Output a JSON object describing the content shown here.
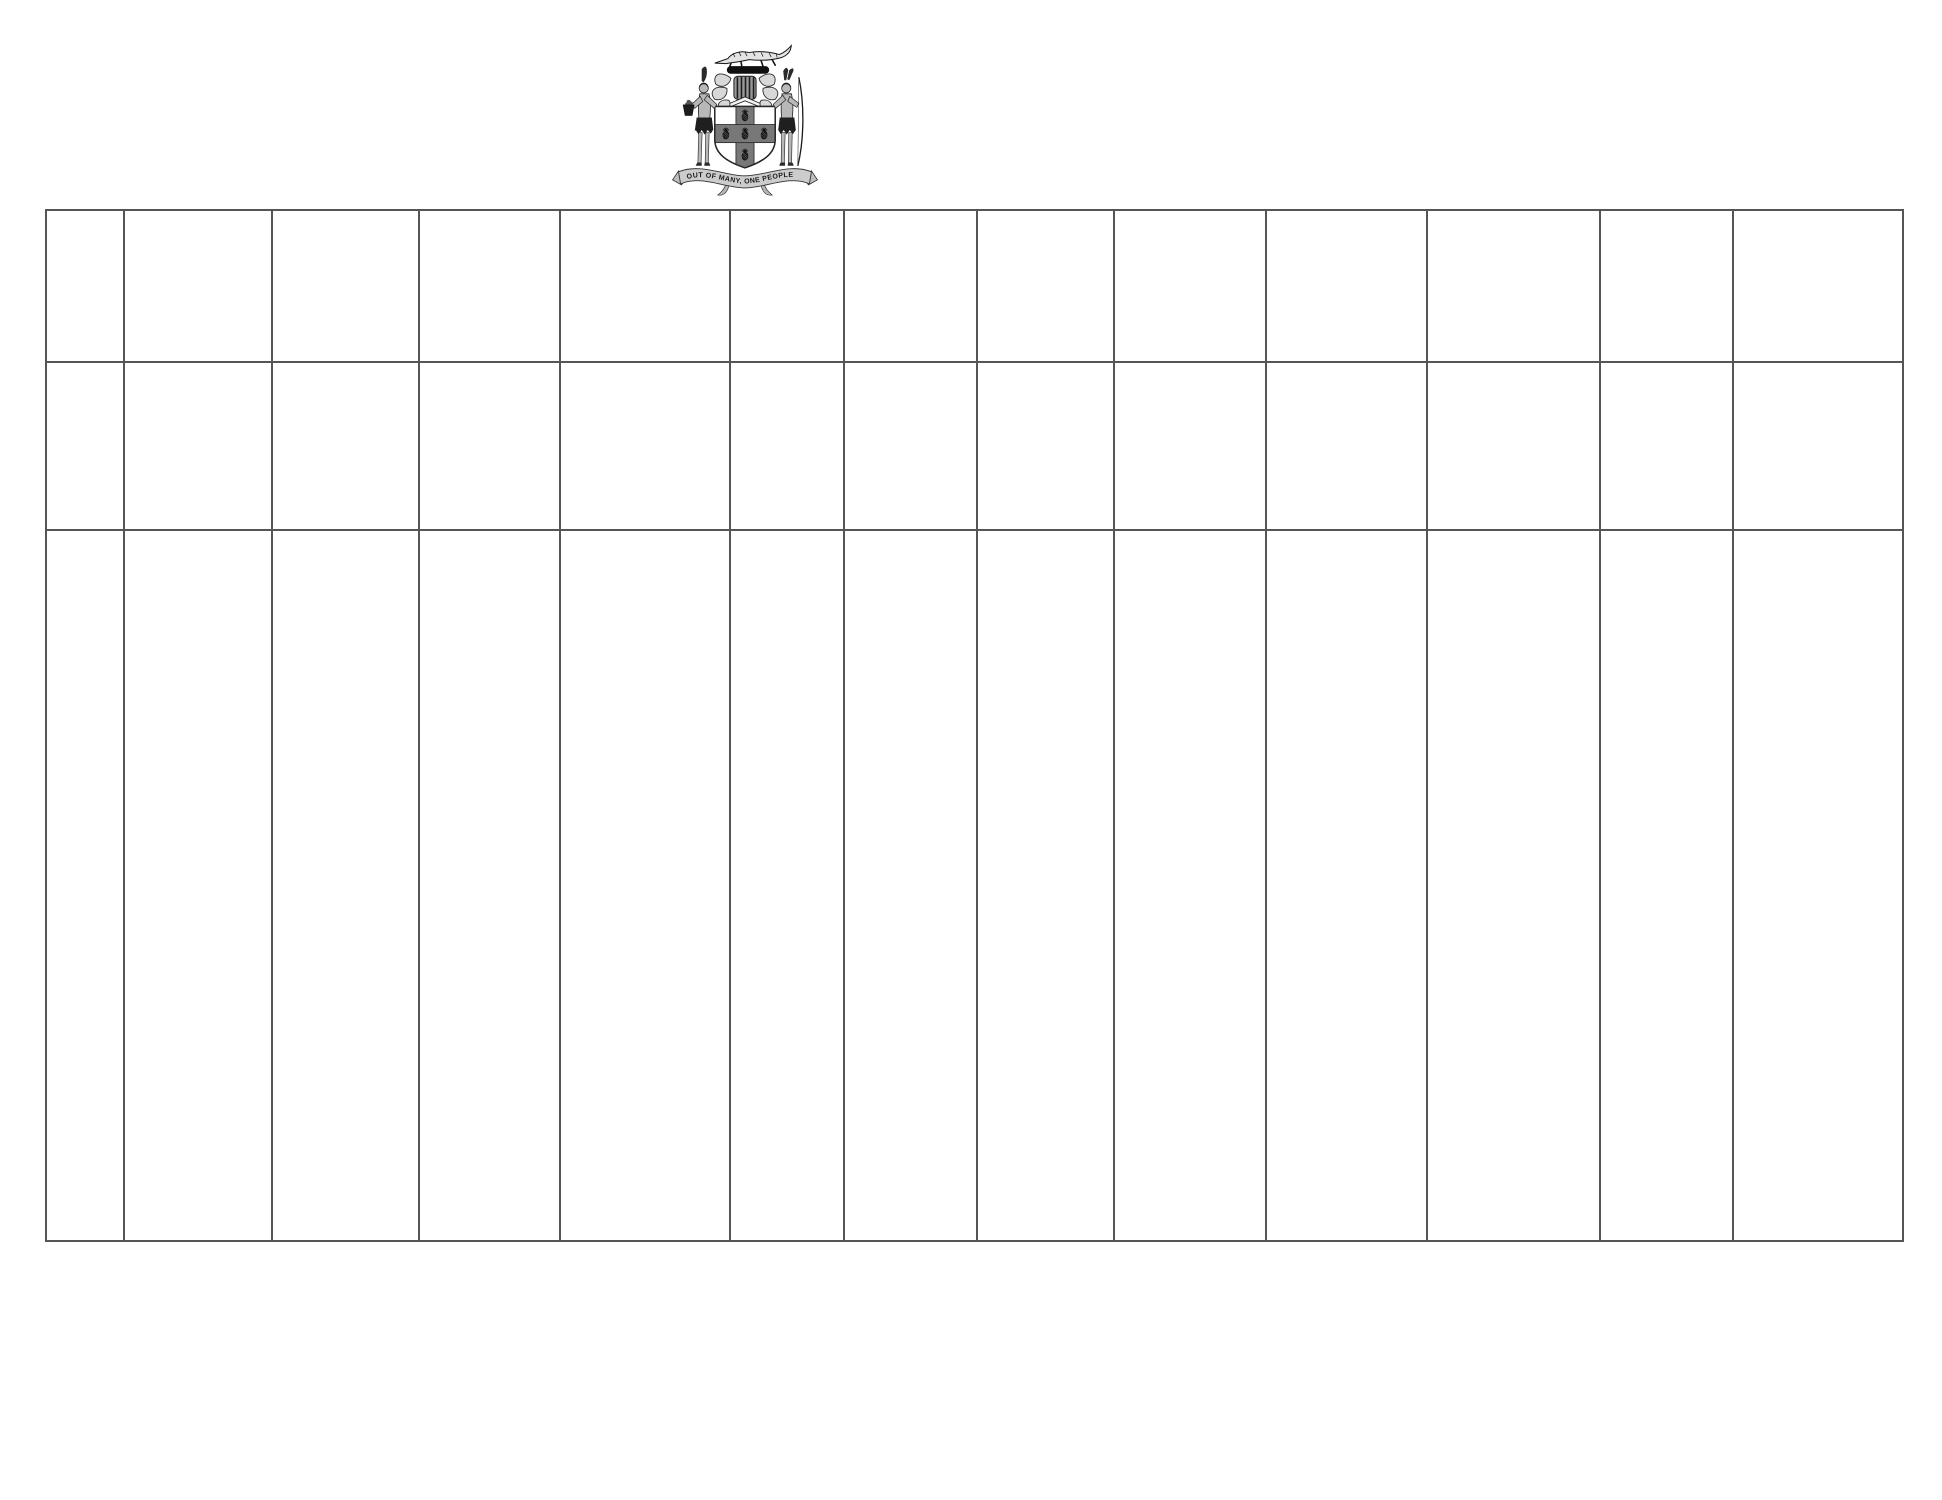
{
  "page": {
    "background_color": "#ffffff",
    "grid_line_color": "#555555"
  },
  "emblem": {
    "name": "Jamaica coat of arms",
    "motto": "OUT OF MANY, ONE PEOPLE"
  },
  "table": {
    "column_count": 13,
    "row_count": 3,
    "rows": [
      {
        "cells": [
          "",
          "",
          "",
          "",
          "",
          "",
          "",
          "",
          "",
          "",
          "",
          "",
          ""
        ]
      },
      {
        "cells": [
          "",
          "",
          "",
          "",
          "",
          "",
          "",
          "",
          "",
          "",
          "",
          "",
          ""
        ]
      },
      {
        "cells": [
          "",
          "",
          "",
          "",
          "",
          "",
          "",
          "",
          "",
          "",
          "",
          "",
          ""
        ]
      }
    ]
  }
}
